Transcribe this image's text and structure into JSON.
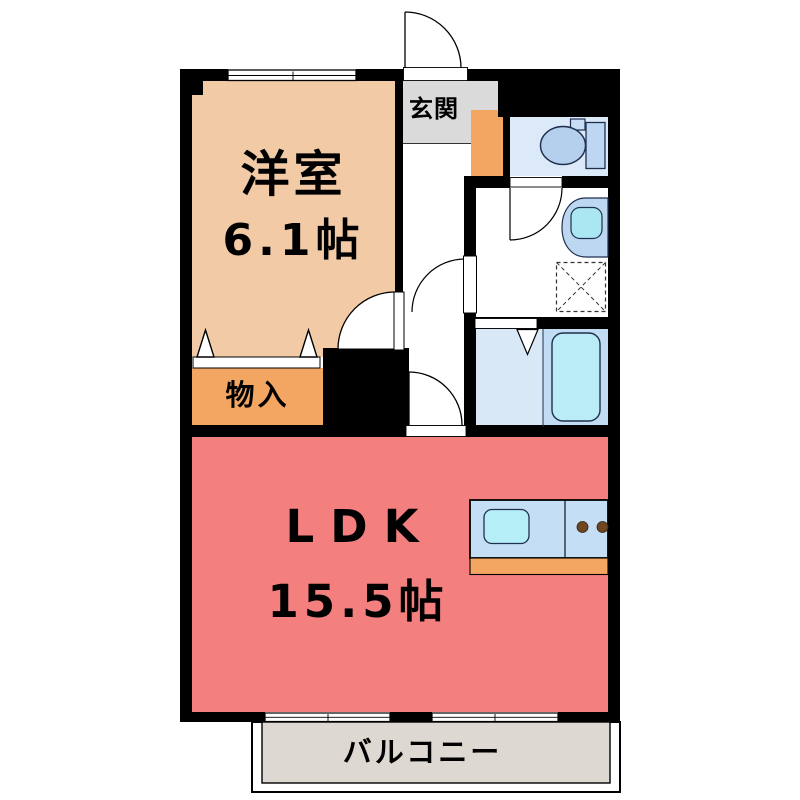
{
  "floorplan": {
    "type": "japanese-apartment-floorplan",
    "rooms": {
      "western_room": {
        "name": "洋室",
        "area": "6.1帖"
      },
      "ldk": {
        "name": "LDK",
        "area": "15.5帖"
      },
      "storage": {
        "name": "物入"
      },
      "entrance": {
        "name": "玄関"
      },
      "balcony": {
        "name": "バルコニー"
      }
    },
    "fixtures": [
      "toilet",
      "washbasin",
      "washing-machine-pan",
      "bathtub",
      "folding-bath-door",
      "kitchen-sink",
      "stove-burners",
      "hinged-doors",
      "sliding-windows",
      "closet-folding-doors"
    ],
    "colors": {
      "wall": "#000000",
      "western_room": "#F2CBA6",
      "ldk": "#F47F7F",
      "storage": "#F3A662",
      "kitchen_base": "#F3A662",
      "entrance_floor": "#DADADA",
      "balcony_floor": "#DDD8D1",
      "toilet_room": "#DBE9F8",
      "bathroom_left": "#D9E8F7",
      "bathroom_right": "#C2DCF4",
      "bathtub": "#B9ECF7",
      "kitchen_counter": "#C4DEF6",
      "sink": "#B6EEF8",
      "stove_burner": "#6F4522"
    }
  }
}
